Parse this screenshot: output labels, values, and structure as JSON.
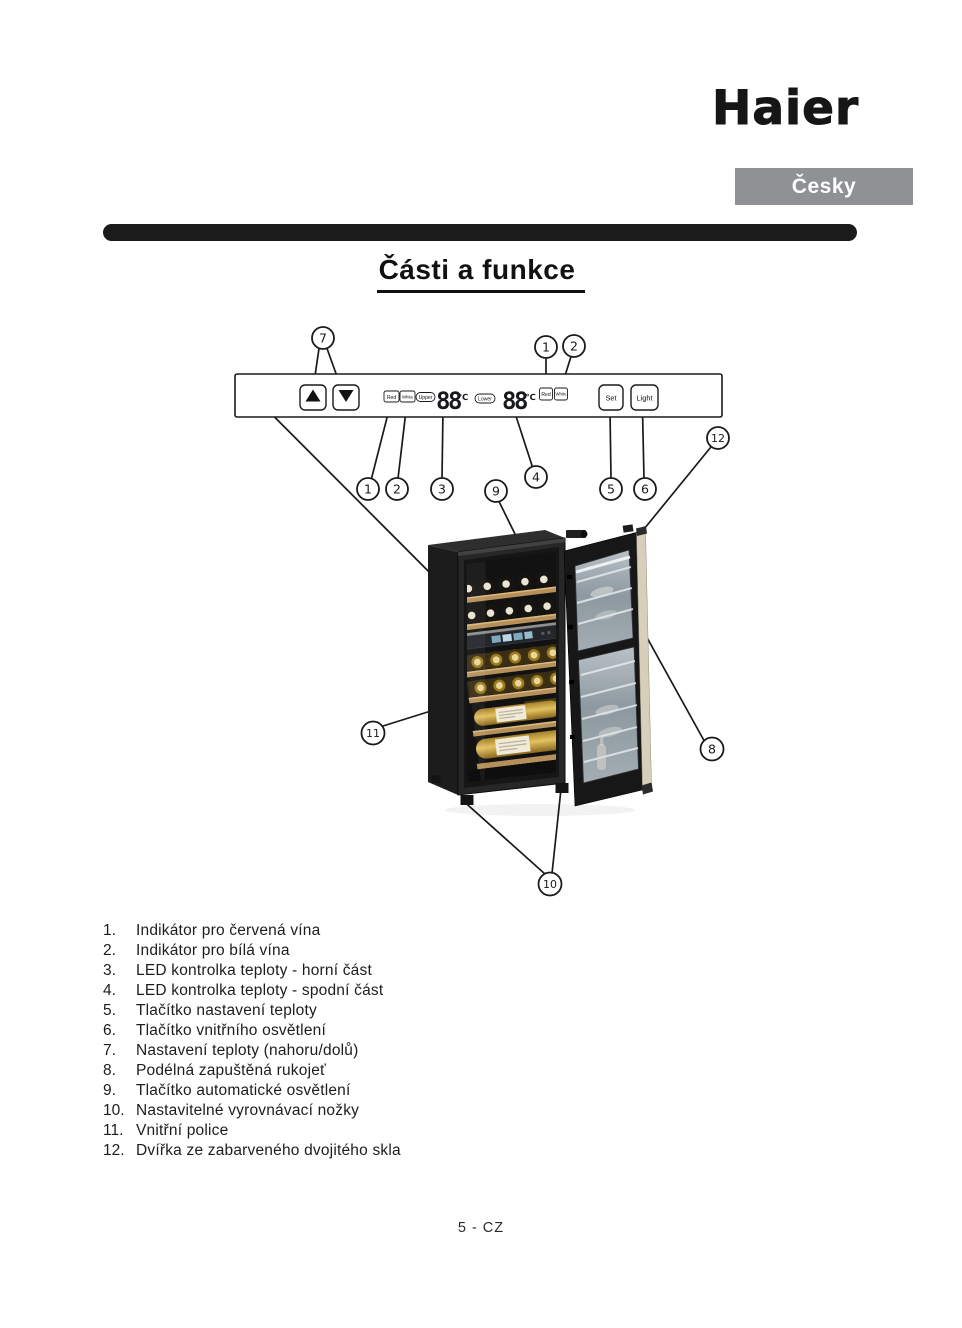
{
  "page": {
    "brand": "Haier",
    "language_label": "Česky",
    "title": "Části a funkce",
    "footer": "5 - CZ"
  },
  "control_panel": {
    "red_indicator": "Red",
    "white_indicator": "White",
    "upper_zone_label": "Upper",
    "lower_zone_label": "Lower",
    "upper_temp_display": "88",
    "lower_temp_display": "88",
    "temp_unit": "℃",
    "set_button": "Set",
    "light_button": "Light"
  },
  "callout_numbers": {
    "n1": "1",
    "n2": "2",
    "n3": "3",
    "n4": "4",
    "n5": "5",
    "n6": "6",
    "n7": "7",
    "n8": "8",
    "n9": "9",
    "n10": "10",
    "n11": "11",
    "n12": "12"
  },
  "parts_list": [
    {
      "num": "1.",
      "label": "Indikátor pro červená vína"
    },
    {
      "num": "2.",
      "label": "Indikátor pro bílá vína"
    },
    {
      "num": "3.",
      "label": "LED kontrolka teploty - horní část"
    },
    {
      "num": "4.",
      "label": "LED kontrolka teploty - spodní část"
    },
    {
      "num": "5.",
      "label": "Tlačítko nastavení teploty"
    },
    {
      "num": "6.",
      "label": "Tlačítko vnitřního osvětlení"
    },
    {
      "num": "7.",
      "label": "Nastavení teploty (nahoru/dolů)"
    },
    {
      "num": "8.",
      "label": "Podélná zapuštěná rukojeť"
    },
    {
      "num": "9.",
      "label": "Tlačítko automatické osvětlení"
    },
    {
      "num": "10.",
      "label": "Nastavitelné vyrovnávací nožky"
    },
    {
      "num": "11.",
      "label": "Vnitřní police"
    },
    {
      "num": "12.",
      "label": "Dvířka ze zabarveného dvojitého skla"
    }
  ]
}
